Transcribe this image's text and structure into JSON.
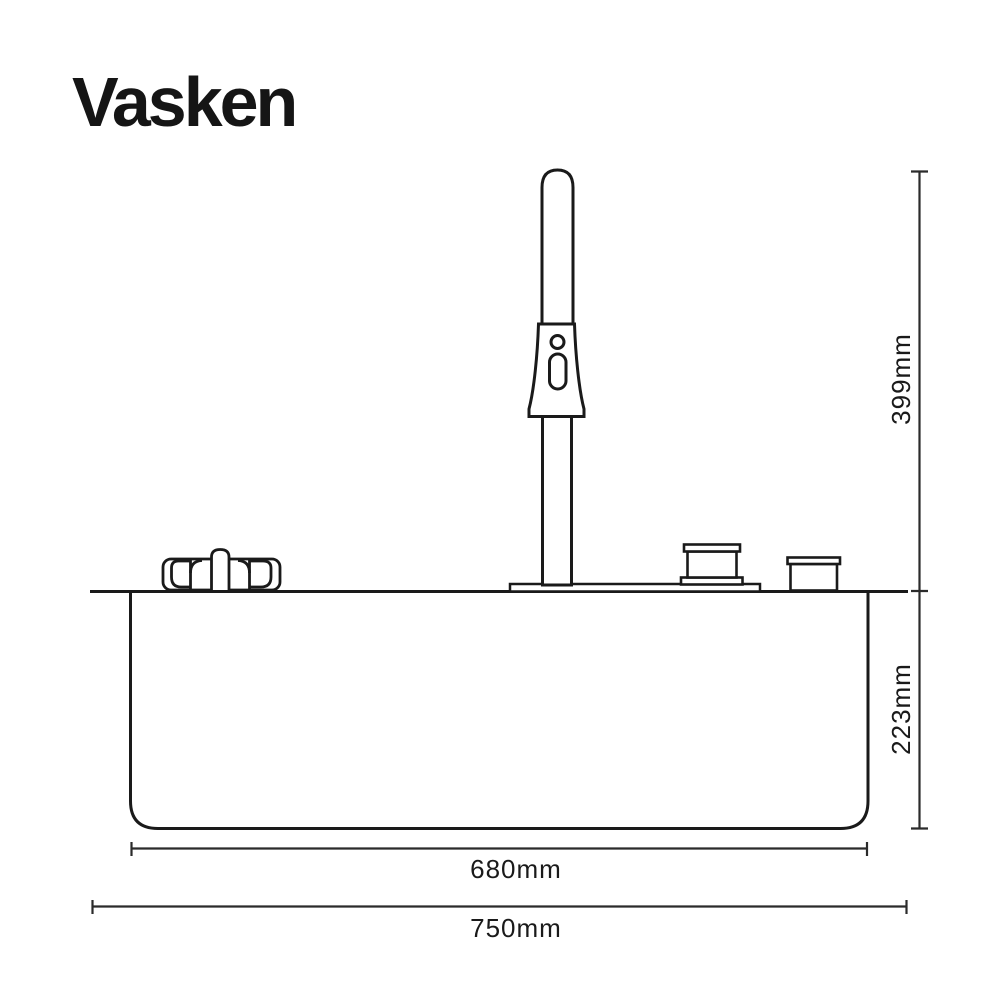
{
  "brand": {
    "name": "Vasken"
  },
  "product_diagram": {
    "type": "technical-line-drawing",
    "subject": "kitchen sink with tall faucet, side elevation",
    "dimensions": {
      "faucet_height": "399mm",
      "basin_depth": "223mm",
      "basin_width": "680mm",
      "overall_width": "750mm"
    },
    "colors": {
      "background": "#ffffff",
      "line": "#1a1a1a",
      "dimension_line": "#2b2b2b"
    }
  }
}
